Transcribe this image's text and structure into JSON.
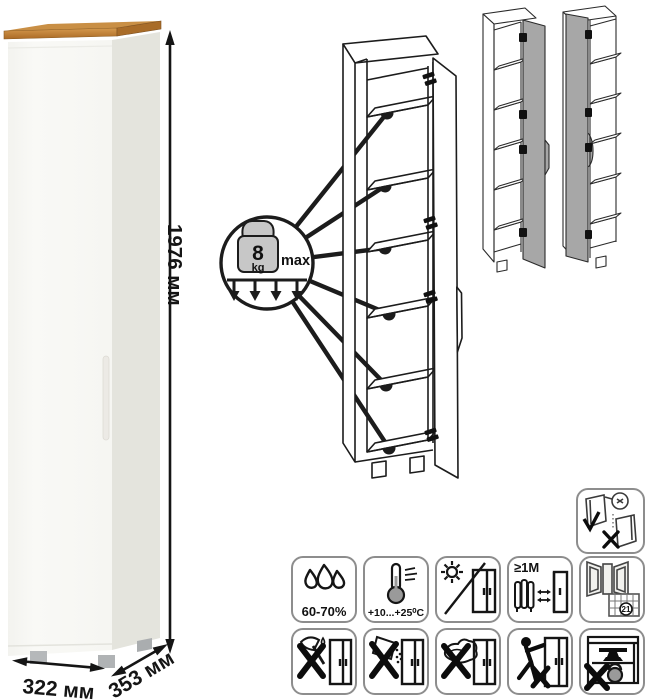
{
  "product": {
    "type": "tall-one-door-cabinet",
    "dimensions": {
      "height": "1976 мм",
      "width": "322 мм",
      "depth": "353 мм"
    },
    "finish_colors": {
      "body_front": "#f8f8f5",
      "body_side": "#e4e4dd",
      "wood_top_light": "#d59a4e",
      "wood_top_dark": "#ab6a25",
      "feet": "#b5b8ba"
    }
  },
  "shelf_load_callout": {
    "value": "8",
    "unit": "kg",
    "qualifier": "max",
    "shelves_indicated": 6
  },
  "door_variants": {
    "count": 2,
    "names": [
      "door-hinged-right-variant",
      "door-hinged-left-variant"
    ],
    "door_color": "#a7a7a7"
  },
  "door_alignment_icon": "door-alignment-check-icon",
  "care_icons": {
    "humidity_label": "60-70%",
    "temperature_label": "+10...+25⁰C",
    "heat_distance_label": "≥1М",
    "ventilation_calendar_day": "21",
    "row1_names": [
      "humidity-icon",
      "temperature-range-icon",
      "no-direct-sunlight-icon",
      "heat-source-distance-icon",
      "ventilation-icon"
    ],
    "row2_names": [
      "no-solvents-icon",
      "no-abrasive-powder-icon",
      "no-wet-cleaning-icon",
      "no-dragging-icon",
      "no-overloading-icon"
    ],
    "line_color": "#1c1c1c",
    "border_color": "#8d8d8d"
  }
}
